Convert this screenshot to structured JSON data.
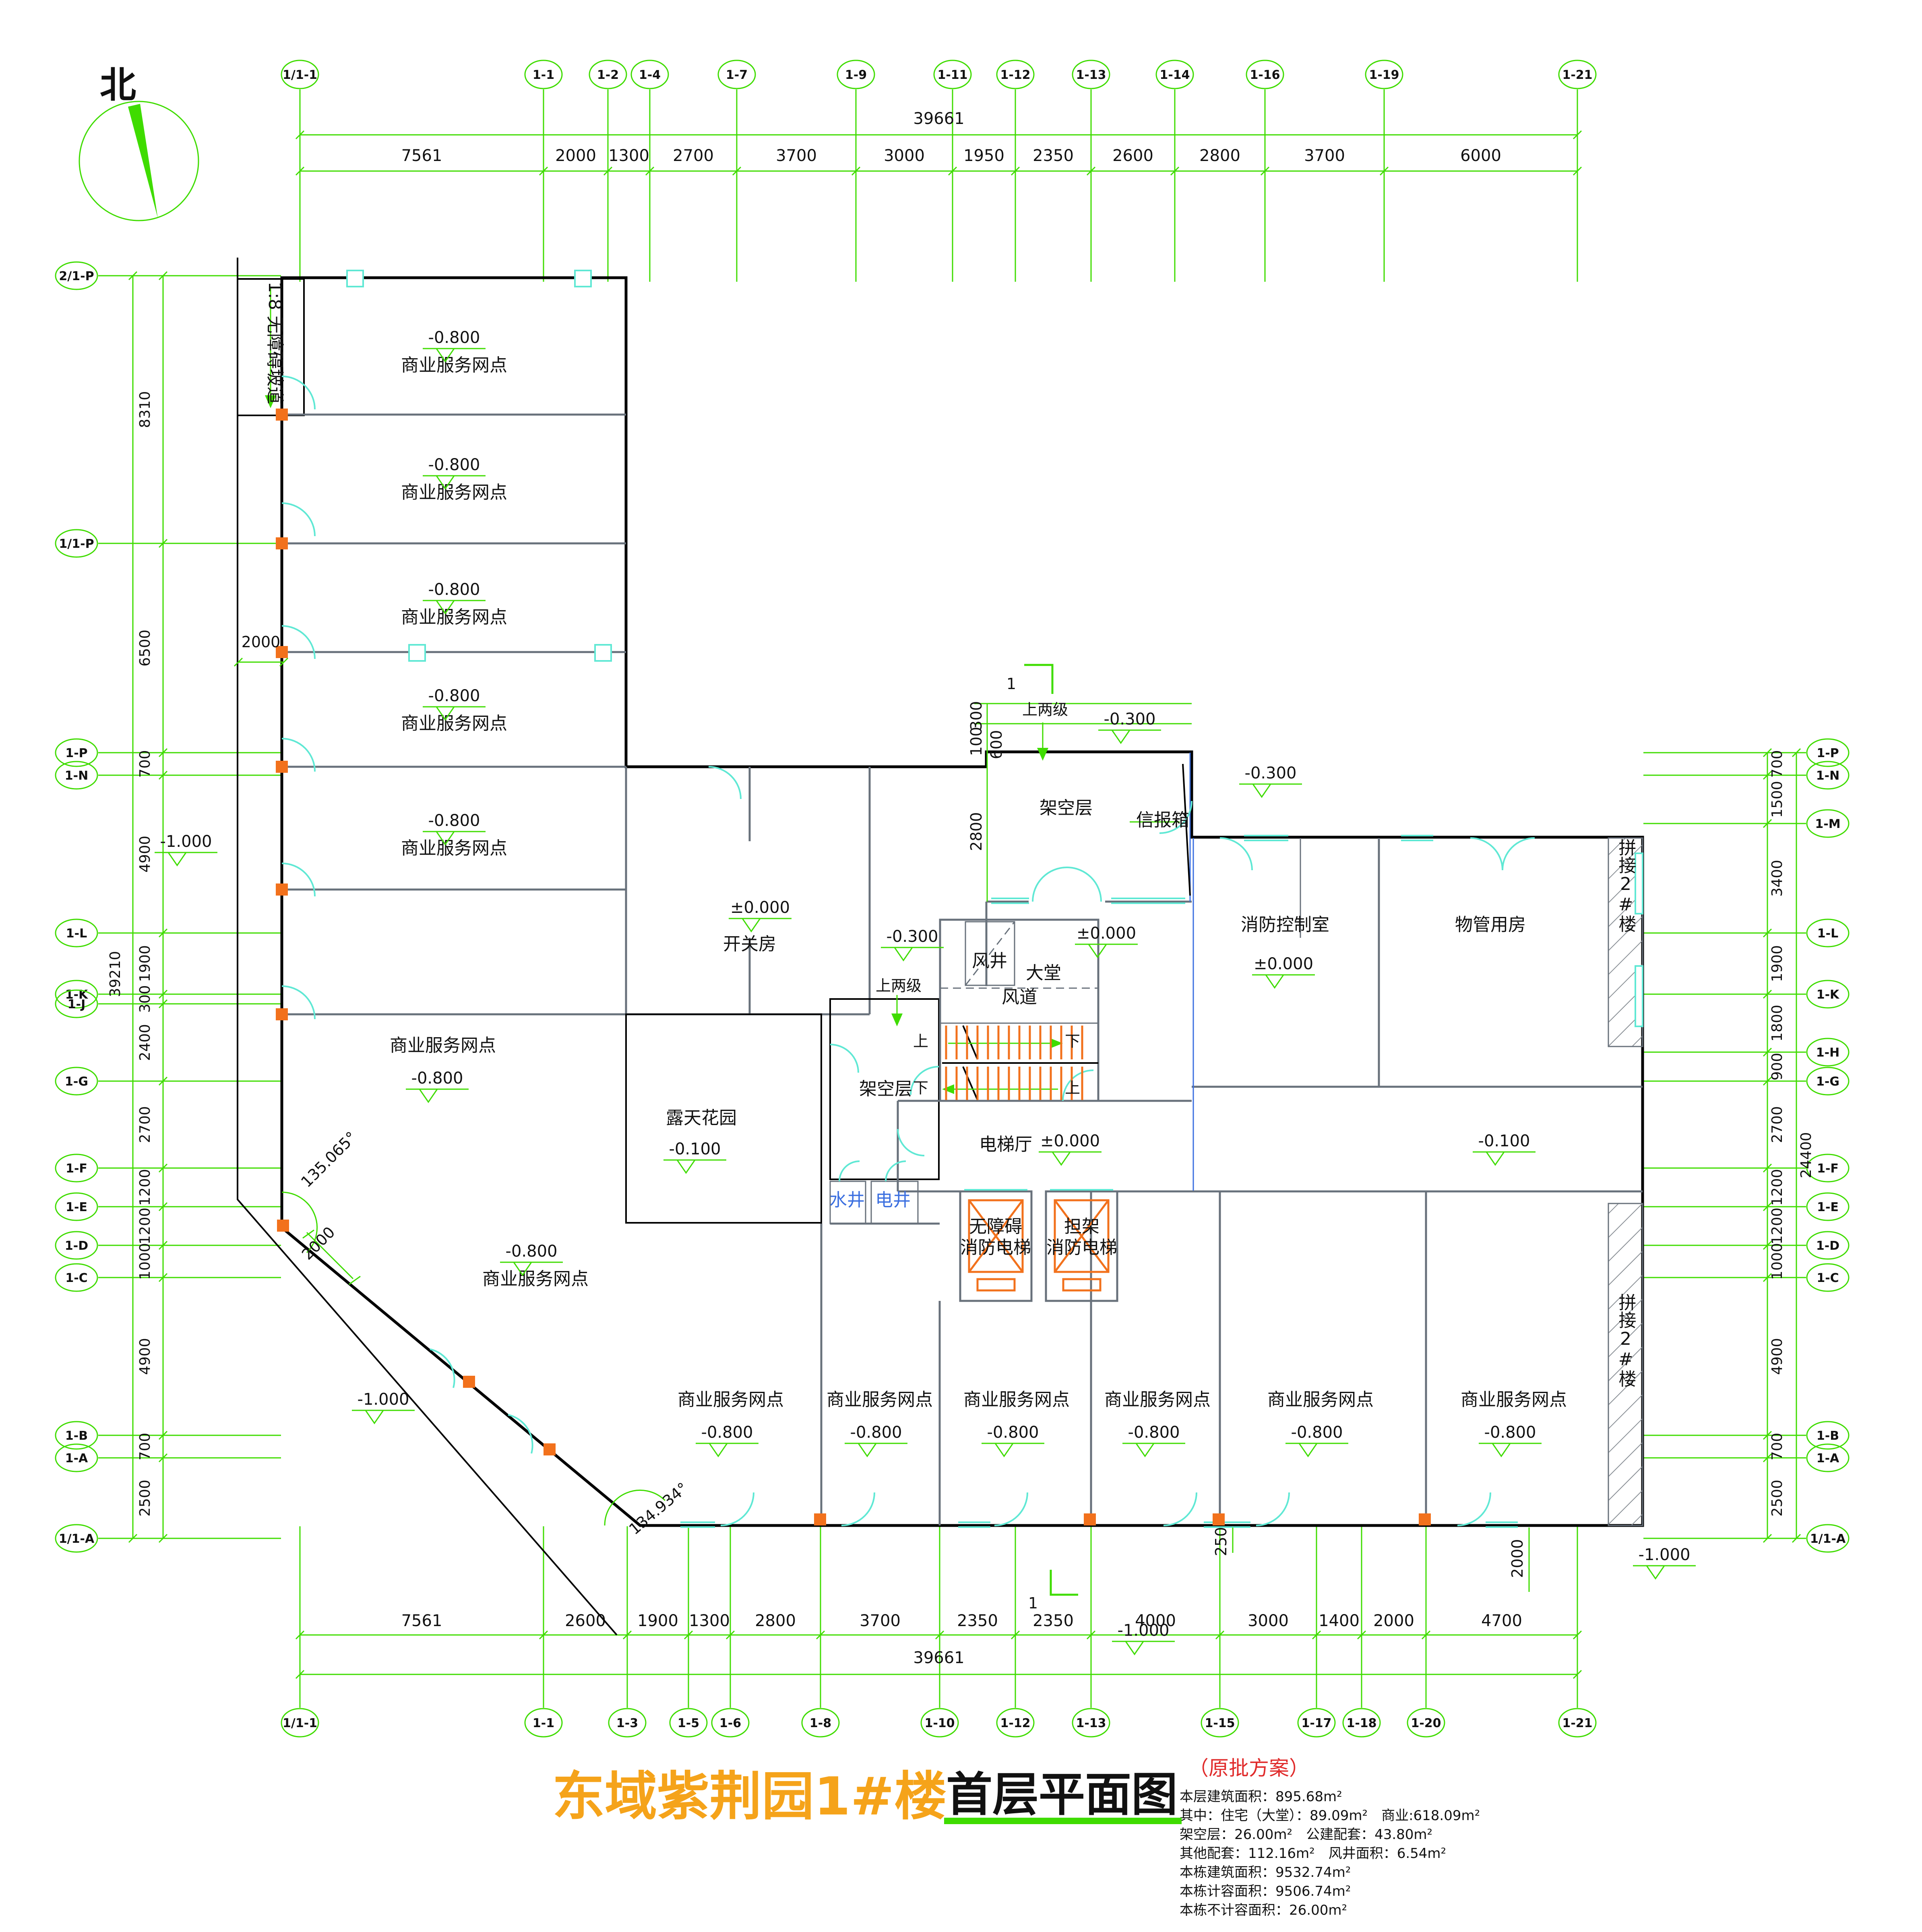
{
  "title": {
    "project": "东域紫荆园1#楼",
    "drawing": "首层平面图",
    "note": "（原批方案）"
  },
  "north": {
    "label": "北"
  },
  "stats": {
    "l1": "本层建筑面积：895.68m²",
    "l2": "其中：住宅（大堂）：89.09m²　商业:618.09m²",
    "l3": "架空层：26.00m²　公建配套：43.80m²",
    "l4": "其他配套：112.16m²　风井面积：6.54m²",
    "l5": "本栋建筑面积：9532.74m²",
    "l6": "本栋计容面积：9506.74m²",
    "l7": "本栋不计容面积：26.00m²"
  },
  "rooms": {
    "shop": "商业服务网点",
    "switch_room": "开关房",
    "garden": "露天花园",
    "void_floor": "架空层",
    "lobby": "大堂",
    "wind_shaft": "风井",
    "wind_duct": "风道",
    "elev_hall": "电梯厅",
    "fire_ctrl": "消防控制室",
    "pm_room": "物管用房",
    "water_shaft": "水井",
    "elec_shaft": "电井",
    "elev1a": "无障碍",
    "elev2a": "担架",
    "fire_elev": "消防电梯",
    "mailbox": "信报箱",
    "join2": "拼接2#楼",
    "ramp": "1:8 无障碍坡道"
  },
  "elev": {
    "zero": "±0.000",
    "m008": "-0.800",
    "m001": "-0.100",
    "m003": "-0.300",
    "m100": "-1.000"
  },
  "ann": {
    "up2": "上两级",
    "sec": "1",
    "up": "上",
    "down": "下",
    "ang1": "135.065°",
    "ang2": "134.934°",
    "d2000": "2000",
    "d250": "250",
    "d300": "300",
    "d600": "600",
    "d100": "100",
    "d2800": "2800"
  },
  "grid": {
    "top": {
      "total": "39661",
      "bubbles": [
        "1/1-1",
        "1-1",
        "1-2",
        "1-4",
        "1-7",
        "1-9",
        "1-11",
        "1-12",
        "1-13",
        "1-14",
        "1-16",
        "1-19",
        "1-21"
      ],
      "segs": [
        "7561",
        "2000",
        "1300",
        "2700",
        "3700",
        "3000",
        "1950",
        "2350",
        "2600",
        "2800",
        "3700",
        "6000"
      ]
    },
    "bottom": {
      "total": "39661",
      "bubbles": [
        "1/1-1",
        "1-1",
        "1-3",
        "1-5",
        "1-6",
        "1-8",
        "1-10",
        "1-12",
        "1-13",
        "1-15",
        "1-17",
        "1-18",
        "1-20",
        "1-21"
      ],
      "segs": [
        "7561",
        "2600",
        "1900",
        "1300",
        "2800",
        "3700",
        "2350",
        "2350",
        "4000",
        "3000",
        "1400",
        "2000",
        "4700"
      ]
    },
    "left": {
      "total": "39210",
      "bubbles": [
        "2/1-P",
        "1/1-P",
        "1-P",
        "1-N",
        "1-L",
        "1-K",
        "1-J",
        "1-G",
        "1-F",
        "1-E",
        "1-D",
        "1-C",
        "1-B",
        "1-A",
        "1/1-A"
      ],
      "segs": [
        "8310",
        "6500",
        "700",
        "4900",
        "1900",
        "300",
        "2400",
        "2700",
        "1200",
        "1200",
        "1000",
        "4900",
        "700",
        "2500"
      ]
    },
    "right": {
      "total": "24400",
      "bubbles": [
        "1-P",
        "1-N",
        "1-M",
        "1-L",
        "1-K",
        "1-H",
        "1-G",
        "1-F",
        "1-E",
        "1-D",
        "1-C",
        "1-B",
        "1-A",
        "1/1-A"
      ],
      "segs": [
        "700",
        "1500",
        "3400",
        "1900",
        "1800",
        "900",
        "2700",
        "1200",
        "1200",
        "1000",
        "4900",
        "700",
        "2500"
      ]
    }
  }
}
